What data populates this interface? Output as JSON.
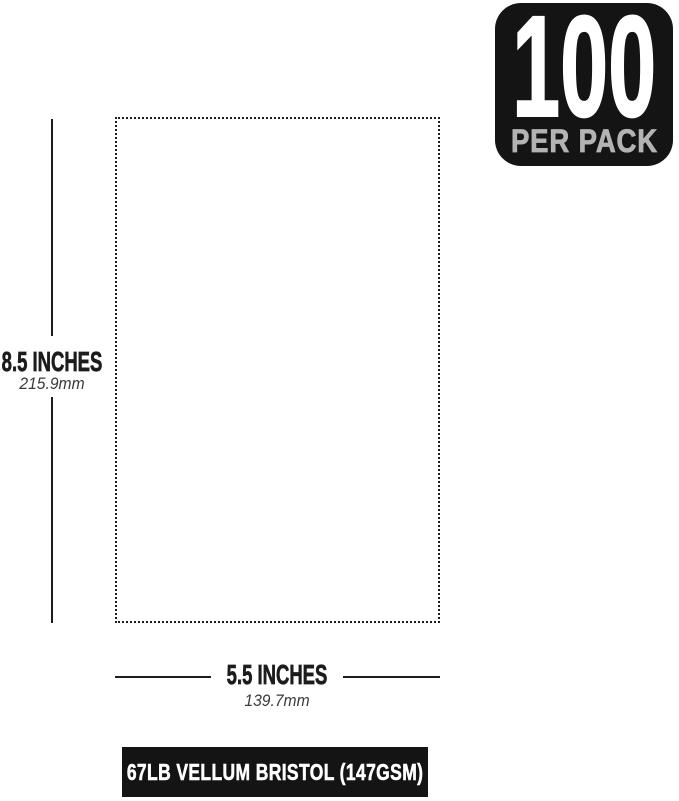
{
  "badge": {
    "count": "100",
    "label": "PER PACK"
  },
  "dimensions": {
    "height": {
      "inches": "8.5 INCHES",
      "metric": "215.9mm"
    },
    "width": {
      "inches": "5.5 INCHES",
      "metric": "139.7mm"
    }
  },
  "footer": {
    "spec": "67LB VELLUM BRISTOL (147GSM)"
  },
  "colors": {
    "bg": "#ffffff",
    "ink": "#1c1c1c",
    "badge_bg": "#141414",
    "badge_secondary": "#b3b3b3",
    "footer_bg": "#141414",
    "footer_text": "#ffffff"
  }
}
